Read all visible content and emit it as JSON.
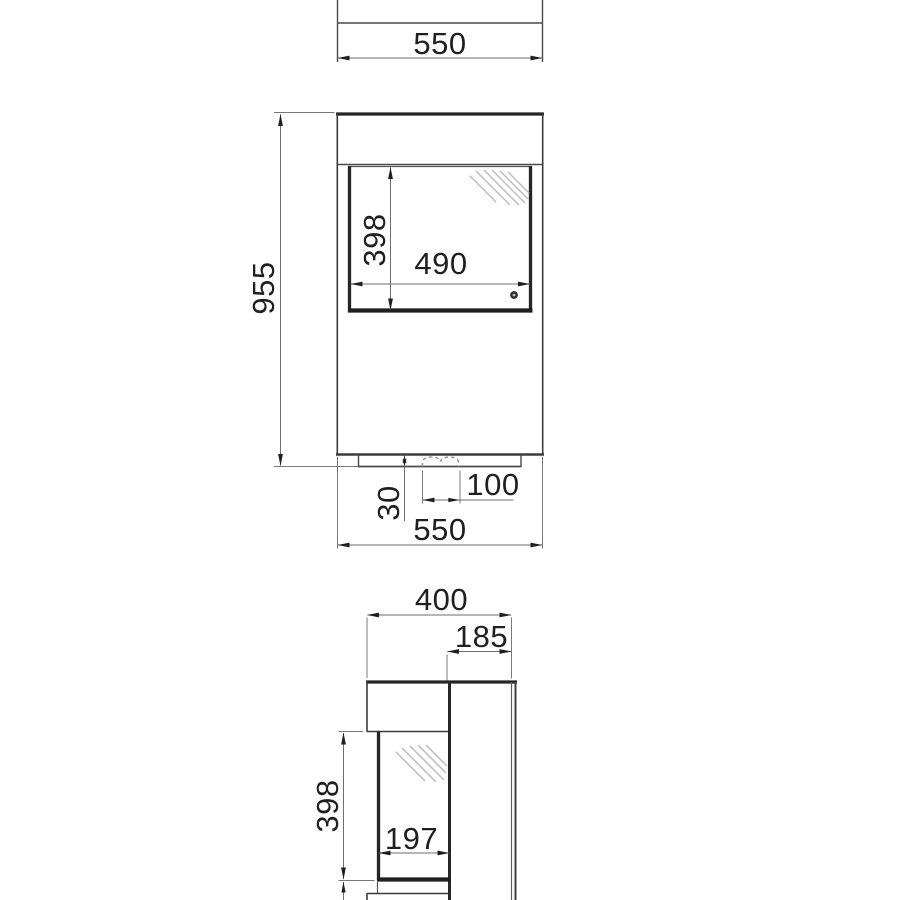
{
  "views": {
    "top": {
      "width_label": "550"
    },
    "front": {
      "height_label": "955",
      "glass_height_label": "398",
      "glass_width_label": "490",
      "plinth_height_label": "30",
      "recess_width_label": "100",
      "width_label": "550"
    },
    "side": {
      "depth_label": "400",
      "rear_depth_label": "185",
      "glass_height_label": "398",
      "glass_depth_label": "197"
    }
  },
  "colors": {
    "background": "#ffffff",
    "outline": "#2a2a2a",
    "dimension_line": "#6e6e6e",
    "text": "#1f1f1f",
    "hatch": "#bdbdbd"
  }
}
